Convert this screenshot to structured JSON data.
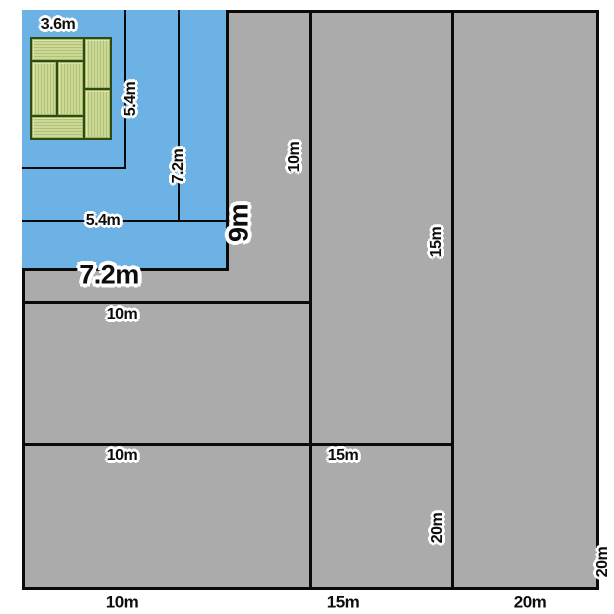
{
  "figure": {
    "kind": "nested-rectangle-size-comparison",
    "rectangles": [
      {
        "width_label": "3.6m",
        "height_label": "5.4m",
        "fill": "blue"
      },
      {
        "width_label": "5.4m",
        "height_label": "7.2m",
        "fill": "blue"
      },
      {
        "width_label": "7.2m",
        "height_label": "9m",
        "fill": "blue"
      },
      {
        "width_label": "10m",
        "height_label": "10m",
        "fill": "gray"
      },
      {
        "width_label": "15m",
        "height_label": "15m",
        "fill": "gray"
      },
      {
        "width_label": "20m",
        "height_label": "20m",
        "fill": "gray"
      }
    ]
  },
  "dimension_labels": [
    "3.6m",
    "5.4m",
    "7.2m",
    "5.4m",
    "9m",
    "7.2m",
    "10m",
    "15m",
    "10m",
    "10m",
    "15m",
    "20m",
    "20m"
  ],
  "scale_labels": [
    "10m",
    "15m",
    "20m"
  ],
  "colors": {
    "background": "#ffffff",
    "gray_area": "#ababab",
    "blue_area": "#6cb2e5",
    "line": "#0a0a0a",
    "tatami_fill": "#ccd994",
    "tatami_border": "#2f4a12",
    "label_text": "#0d0d0d",
    "label_halo": "#ffffff"
  }
}
